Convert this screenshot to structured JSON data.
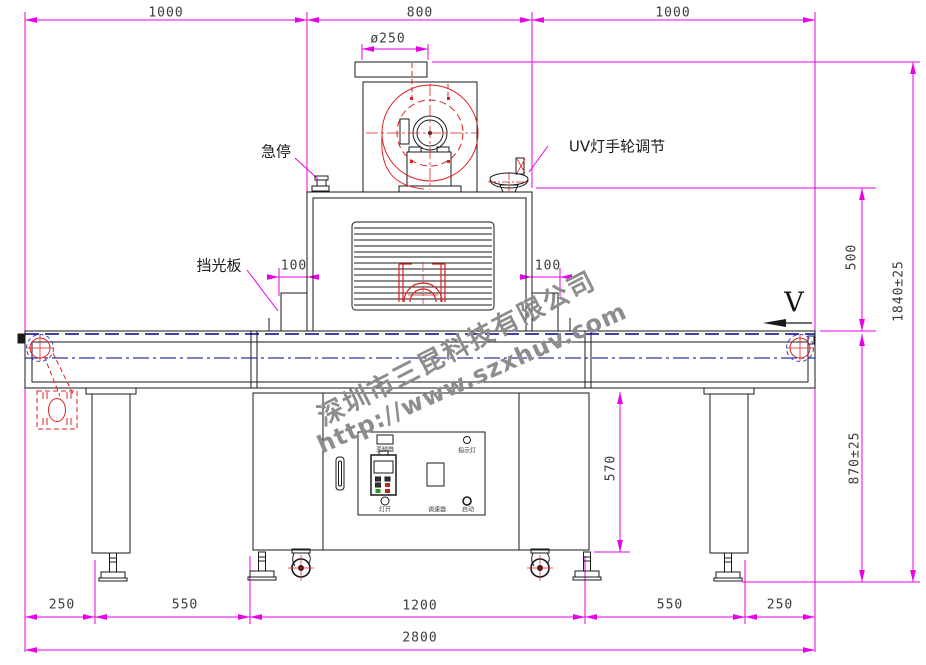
{
  "dimensions": {
    "top": [
      "1000",
      "800",
      "1000"
    ],
    "flange_diameter": "ø250",
    "lamp_clearance_left": "100",
    "lamp_clearance_right": "100",
    "lamp_section_height": "500",
    "overall_height": "1840±25",
    "belt_height": "870±25",
    "cabinet_height": "570",
    "bottom": [
      "250",
      "550",
      "1200",
      "550",
      "250"
    ],
    "overall_width": "2800"
  },
  "callouts": {
    "emergency_stop": "急停",
    "uv_handwheel": "UV灯手轮调节",
    "light_shield": "挡光板",
    "belt_direction": "V"
  },
  "control_panel": {
    "inverter": "变频器",
    "lamp_switch": "灯开",
    "speed_controller": "调速器",
    "start": "启动",
    "indicator": "指示灯"
  },
  "watermark": {
    "company": "深圳市三昆科技有限公司",
    "website": "http://www.szxhuv.com"
  },
  "colors": {
    "dimension_line": "#e800e8",
    "outline": "#1a1a1a",
    "belt_line": "#00008b",
    "red_detail": "#e02020",
    "watermark_gray": "#8d8d8d"
  }
}
